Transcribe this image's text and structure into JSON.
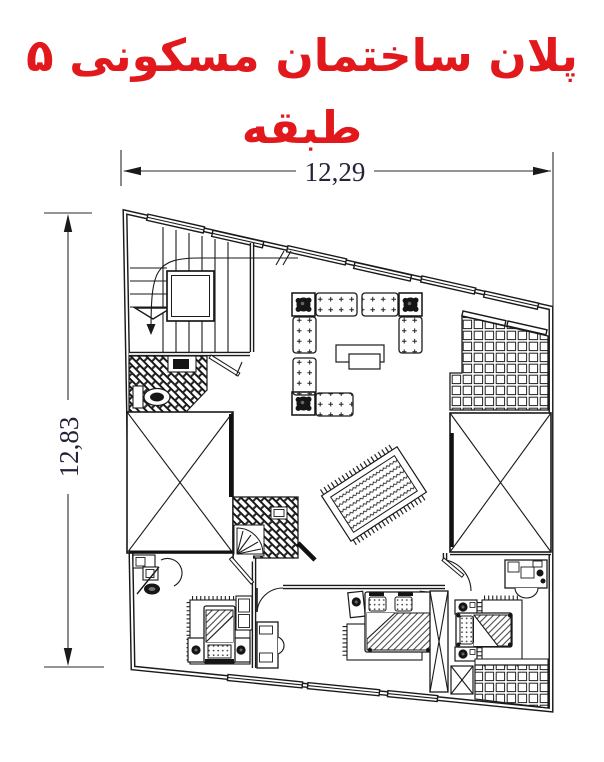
{
  "title": {
    "text": "پلان ساختمان مسکونی ۵ طبقه",
    "language": "fa",
    "color": "#e2191c"
  },
  "dimensions": {
    "width_label": "12,29",
    "height_label": "12,83"
  },
  "drawing": {
    "type": "architectural-floor-plan",
    "background": "#ffffff",
    "line_color": "#1a1a1a",
    "dimension_text_color": "#23233a",
    "rooms_and_symbols": [
      "staircase",
      "elevator",
      "wc",
      "middle-bathroom",
      "quarter-fan-shower",
      "living-room-sofa-set",
      "potted-plant",
      "coffee-tables",
      "persian-rug",
      "lightwell-void-left",
      "lightwell-void-right",
      "tiled-terrace-top-right",
      "tiled-terrace-bottom-right",
      "bedroom-left",
      "bedroom-middle",
      "bedroom-right",
      "single-bed",
      "double-bed",
      "nightstand",
      "dresser",
      "desk",
      "chair",
      "closet",
      "toilet",
      "sink",
      "door-swing",
      "window-band"
    ]
  }
}
